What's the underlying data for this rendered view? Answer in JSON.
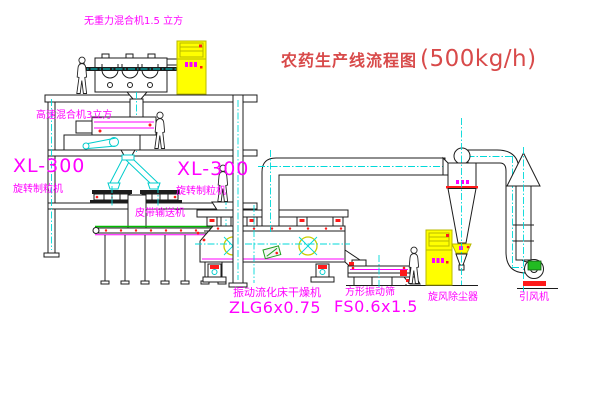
{
  "title": {
    "text": "农药生产线流程图",
    "capacity": "(500kg/h)"
  },
  "labels": {
    "gravity_mixer": "无重力混合机1.5 立方",
    "high_speed_mixer": "高速混合机3立方",
    "granulator_left_model": "XL-300",
    "granulator_left_name": "旋转制粒机",
    "granulator_center_model": "XL-300",
    "granulator_center_name": "旋转制粒机",
    "belt_conveyor": "皮带输送机",
    "dryer_name": "振动流化床干燥机",
    "dryer_model": "ZLG6x0.75",
    "sieve_name": "方形振动筛",
    "sieve_model": "FS0.6x1.5",
    "cyclone": "旋风除尘器",
    "fan": "引风机"
  },
  "colors": {
    "label_magenta": "#ff00ff",
    "title_red": "#d84a4a",
    "centerline_cyan": "#00d9d9",
    "cabinet_yellow": "#ffff00",
    "accent_red": "#ff1a1a",
    "motor_green": "#22bb22",
    "line_black": "#1c1c1c",
    "background": "#ffffff"
  }
}
